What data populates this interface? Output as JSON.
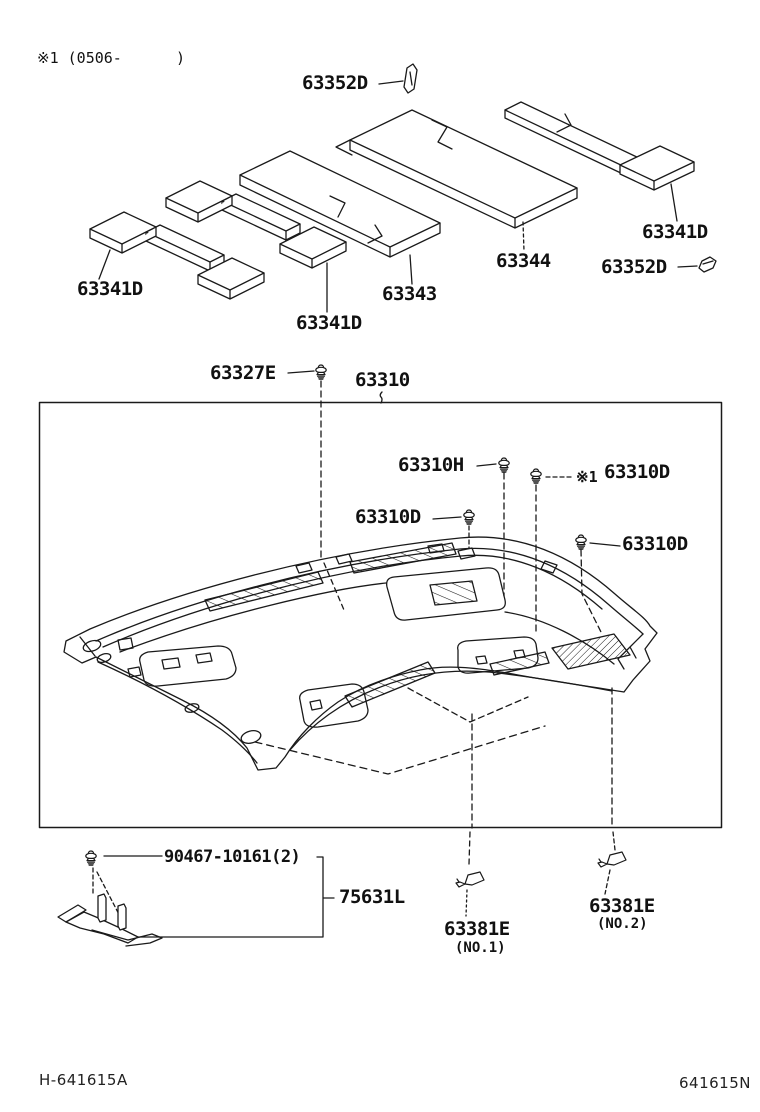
{
  "page": {
    "note_top": "※1 (0506-      )",
    "footer_left": "H-641615A",
    "footer_right": "641615N"
  },
  "labels": {
    "p63352d_top": "63352D",
    "p63341d_left": "63341D",
    "p63341d_mid": "63341D",
    "p63343": "63343",
    "p63344": "63344",
    "p63341d_right": "63341D",
    "p63352d_right": "63352D",
    "p63327e": "63327E",
    "p63310": "63310",
    "p63310h": "63310H",
    "ref_mark": "※1",
    "p63310d_ref": "63310D",
    "p63310d_left": "63310D",
    "p63310d_right": "63310D",
    "p90467": "90467-10161(2)",
    "p75631l": "75631L",
    "p63381e_no1": "63381E",
    "p63381e_no1_sub": "(NO.1)",
    "p63381e_no2": "63381E",
    "p63381e_no2_sub": "(NO.2)"
  },
  "colors": {
    "line": "#1a1a1a",
    "background": "#ffffff"
  }
}
